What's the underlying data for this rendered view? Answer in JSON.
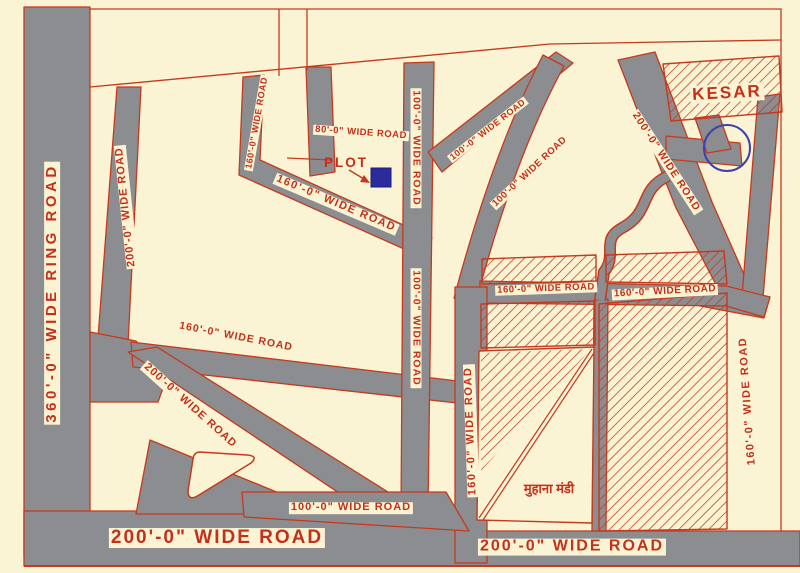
{
  "colors": {
    "background": "#faf4d4",
    "road_fill": "#8b8d90",
    "line_red": "#c7391d",
    "text_red": "#c4301a",
    "plot_blue": "#2b2b9e",
    "circle_blue": "#3f3fae"
  },
  "labels": {
    "ring_road": "360'-0\" WIDE RING ROAD",
    "wide_200": "200'-0\" WIDE ROAD",
    "wide_160": "160'-0\" WIDE ROAD",
    "wide_100": "100'-0\" WIDE ROAD",
    "wide_80": "80'-0\" WIDE ROAD",
    "kesar": "KESAR",
    "plot": "PLOT",
    "muhana_mandi": "मुहाना मंडी"
  }
}
